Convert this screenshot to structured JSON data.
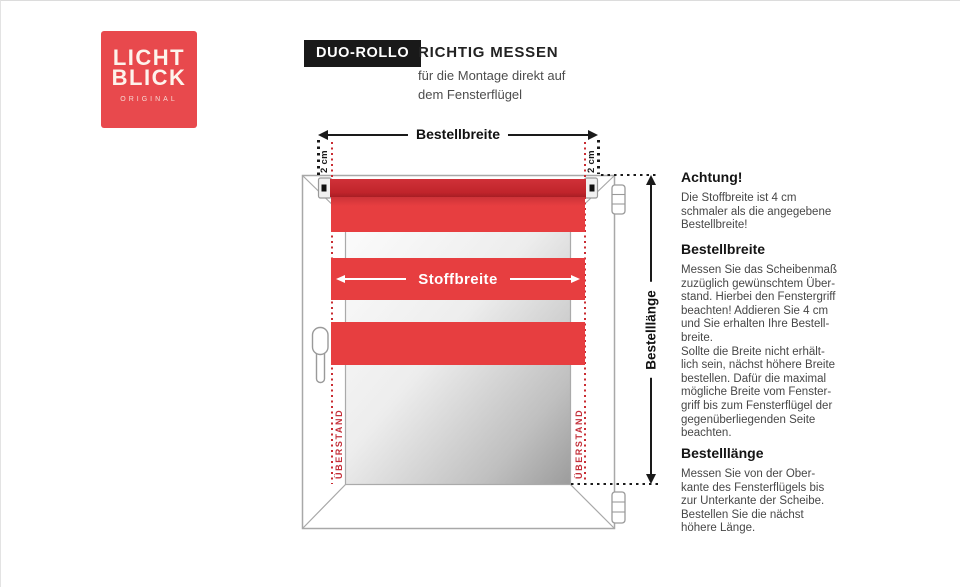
{
  "brand": {
    "line1": "LICHT",
    "line2": "BLICK",
    "subtitle": "ORIGINAL"
  },
  "header": {
    "badge": "DUO-ROLLO",
    "title": "RICHTIG MESSEN",
    "subtitle": "für die Montage direkt auf\ndem Fensterflügel"
  },
  "diagram": {
    "bestellbreite_label": "Bestellbreite",
    "stoffbreite_label": "Stoffbreite",
    "bestelllaenge_label": "Bestelllänge",
    "offset_left": "2 cm",
    "offset_right": "2 cm",
    "ueberstand_left": "ÜBERSTAND",
    "ueberstand_right": "ÜBERSTAND"
  },
  "info": {
    "sections": [
      {
        "heading": "Achtung!",
        "body": "Die Stoffbreite ist 4 cm\nschmaler als die angegebene\nBestellbreite!"
      },
      {
        "heading": "Bestellbreite",
        "body": "Messen Sie das Scheibenmaß\nzuzüglich gewünschtem Über-\nstand. Hierbei den Fenstergriff\nbeachten! Addieren Sie 4 cm\nund Sie erhalten Ihre Bestell-\nbreite.\nSollte die Breite nicht erhält-\nlich sein, nächst höhere Breite\nbestellen. Dafür die maximal\nmögliche Breite vom Fenster-\ngriff bis zum Fensterflügel der\ngegenüberliegenden Seite\nbeachten."
      },
      {
        "heading": "Bestelllänge",
        "body": "Messen Sie von der Ober-\nkante des Fensterflügels bis\nzur Unterkante der Scheibe.\nBestellen Sie die nächst\nhöhere Länge."
      }
    ]
  },
  "colors": {
    "brand_red": "#e8494d",
    "blind_red": "#e73e40",
    "tube_red": "#c0242b",
    "badge_bg": "#191919",
    "dotted_red": "#c92c32",
    "frame_grey": "#a8a8a8"
  }
}
